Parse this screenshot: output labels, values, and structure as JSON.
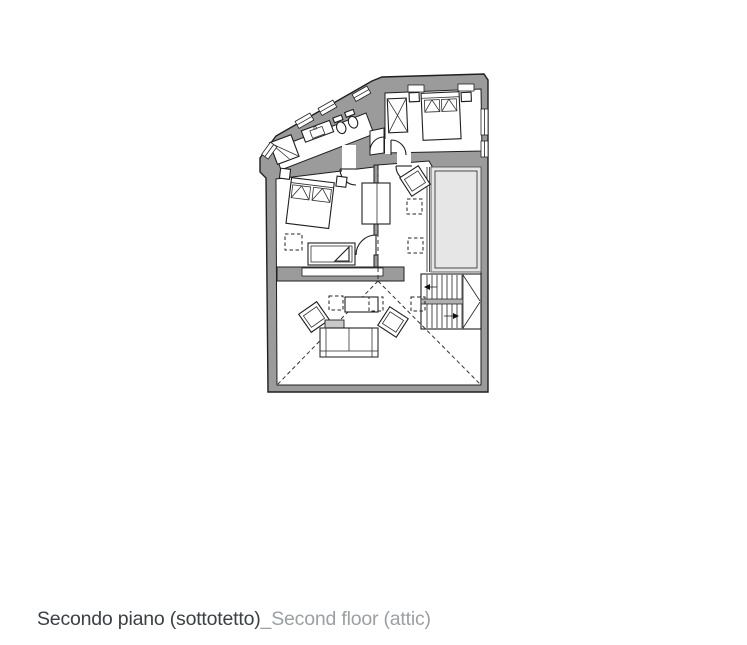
{
  "caption": {
    "title_italian": "Secondo piano (sottotetto)",
    "title_english": "_Second floor (attic)"
  },
  "colors": {
    "wall_fill": "#9b9b9b",
    "terrace_fill": "#e6e6e6",
    "line": "#1f1f1f",
    "caption_primary": "#3b4046",
    "caption_secondary": "#9aa0a5",
    "background": "#ffffff"
  },
  "plan": {
    "floor_label_italian": "Secondo piano (sottotetto)",
    "floor_label_english": "Second floor (attic)",
    "rooms": [
      {
        "name": "bathroom",
        "elements": [
          "shower",
          "washbasin-counter",
          "toilet",
          "bidet",
          "door",
          "windows"
        ]
      },
      {
        "name": "bedroom-top",
        "elements": [
          "double-bed",
          "pillows",
          "wardrobe-x",
          "nightstand",
          "nightstand",
          "door",
          "windows"
        ]
      },
      {
        "name": "bedroom-middle",
        "elements": [
          "double-bed",
          "pillows",
          "nightstand",
          "nightstand",
          "daybed",
          "wardrobe",
          "skylight-dashed",
          "door"
        ]
      },
      {
        "name": "landing-open-area",
        "elements": [
          "armchair",
          "skylight-dashed",
          "skylight-dashed",
          "roof-ridge-dashed"
        ]
      },
      {
        "name": "terrace",
        "elements": [
          "railing"
        ]
      },
      {
        "name": "staircase",
        "elements": [
          "upper-flight",
          "lower-flight",
          "landing-triangle",
          "direction-arrow-left",
          "direction-arrow-right"
        ]
      },
      {
        "name": "living-area",
        "elements": [
          "sofa",
          "chaise",
          "coffee-table",
          "armchair",
          "armchair",
          "skylight-dashed",
          "skylight-dashed",
          "skylight-dashed",
          "roof-hip-dashed",
          "roof-hip-dashed",
          "low-wall-shelf"
        ]
      }
    ]
  }
}
